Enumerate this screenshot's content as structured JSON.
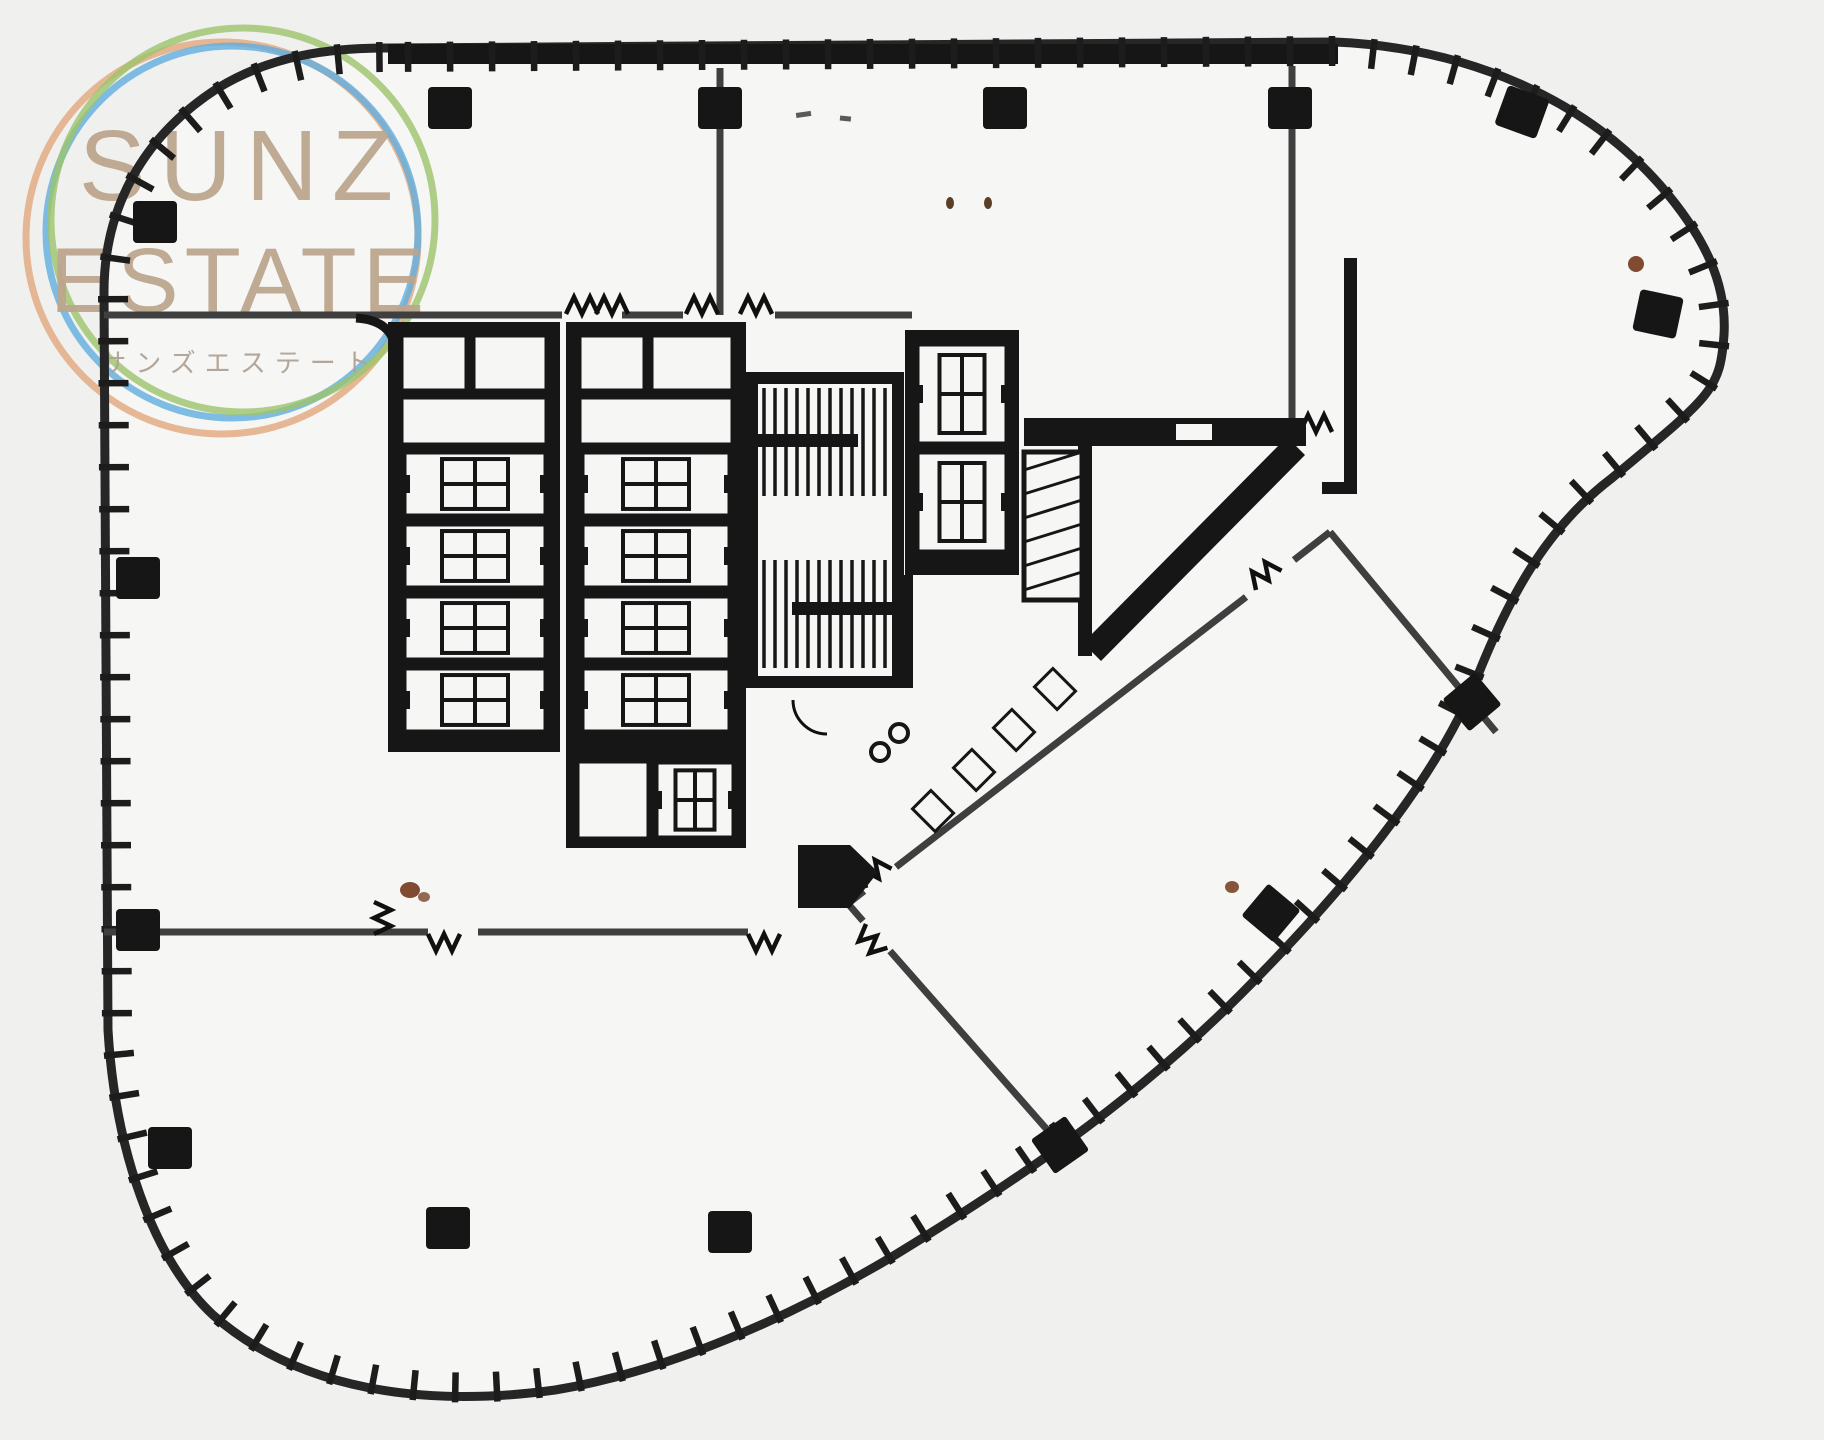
{
  "watermark": {
    "line1": "SUNZ",
    "line2": "ESTATE",
    "subtitle": "サンズエステート",
    "text_color": "#bda68e",
    "rings": {
      "green": "#9cc46c",
      "blue": "#62aede",
      "orange": "#e2a87c"
    }
  },
  "plan": {
    "background": "#f0f0ef",
    "floor_fill": "#f6f6f5",
    "wall_color": "#161616",
    "partition_color": "#3f3f3f",
    "mullion_color": "#1c1c1c",
    "speck_color": "#6b2d0e",
    "counts": {
      "column_count": 15,
      "rotated_column_count": 3,
      "elevator_cars": 11,
      "stairwells": 2,
      "wc_fixtures": 4
    }
  }
}
